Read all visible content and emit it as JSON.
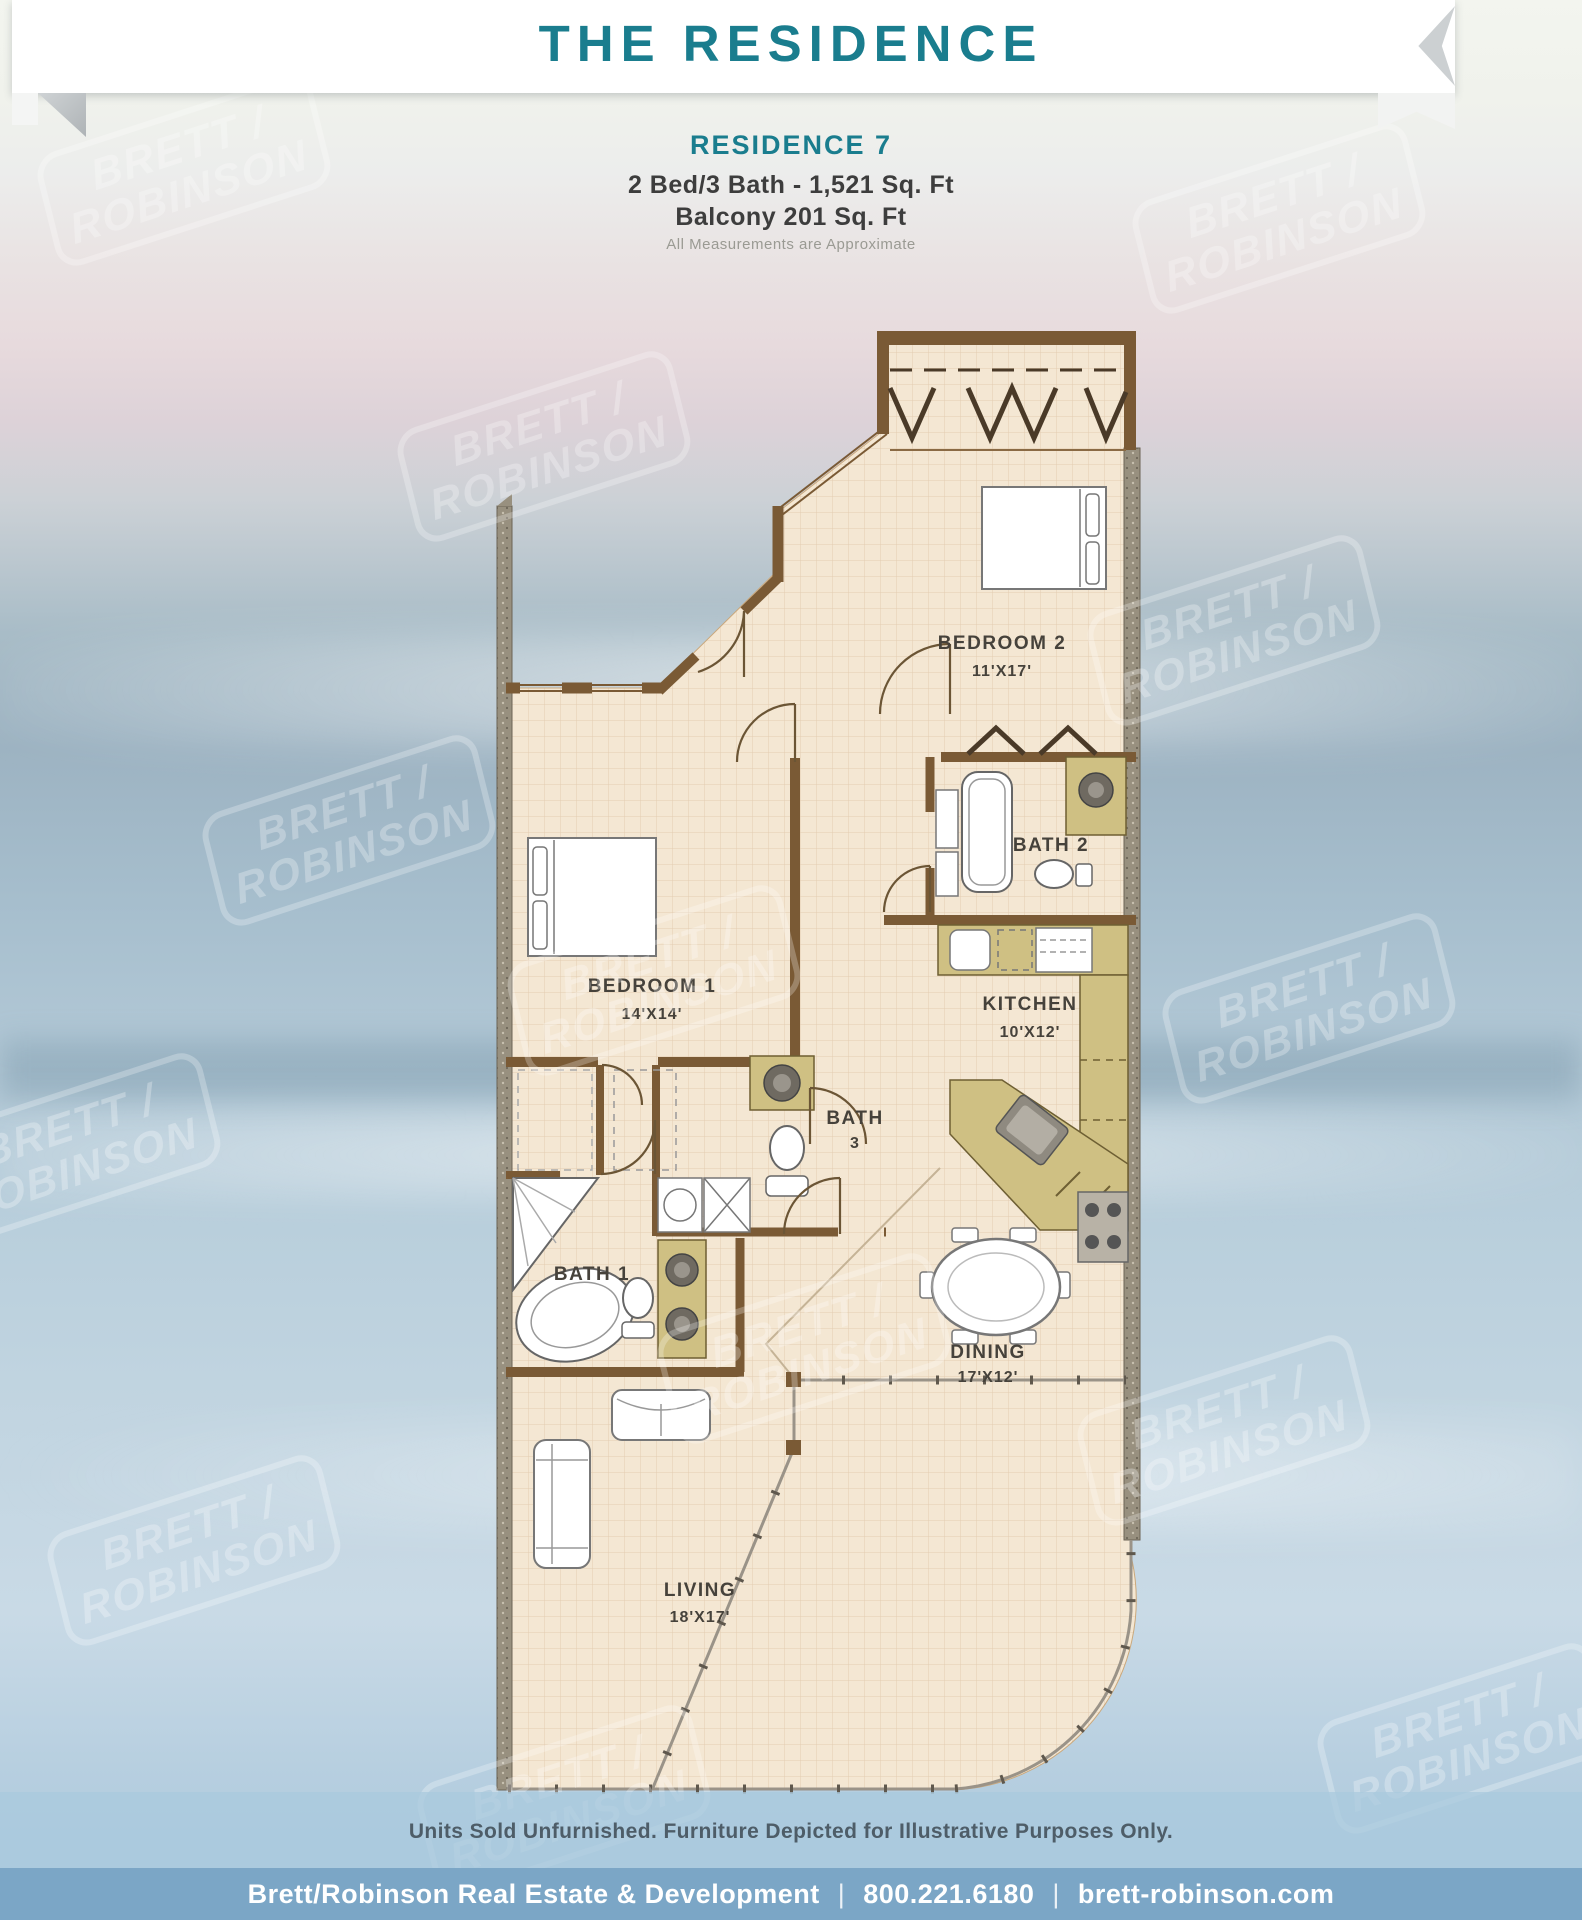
{
  "header": {
    "title": "THE RESIDENCE"
  },
  "unit": {
    "name": "RESIDENCE 7",
    "specs": "2 Bed/3 Bath - 1,521 Sq. Ft",
    "balcony": "Balcony 201 Sq. Ft",
    "disclaimer": "All Measurements are Approximate"
  },
  "floorplan": {
    "rooms": [
      {
        "name": "BEDROOM 2",
        "dims": "11'X17'"
      },
      {
        "name": "BATH 2",
        "dims": ""
      },
      {
        "name": "KITCHEN",
        "dims": "10'X12'"
      },
      {
        "name": "BEDROOM 1",
        "dims": "14'X14'"
      },
      {
        "name": "BATH",
        "dims": "3"
      },
      {
        "name": "BATH 1",
        "dims": ""
      },
      {
        "name": "DINING",
        "dims": "17'X12'"
      },
      {
        "name": "LIVING",
        "dims": "18'X17'"
      }
    ]
  },
  "watermark": {
    "line1": "BRETT /",
    "line2": "ROBINSON"
  },
  "notes": {
    "furnishing": "Units Sold Unfurnished. Furniture Depicted for Illustrative Purposes Only."
  },
  "footer": {
    "company": "Brett/Robinson Real Estate & Development",
    "phone": "800.221.6180",
    "website": "brett-robinson.com",
    "separator": "|"
  },
  "colors": {
    "accent_teal": "#1a7d8e",
    "floor_tan": "#f4e7d3",
    "wall_brown": "#7a5a35",
    "cabinet_khaki": "#cfc083",
    "footer_blue": "#7ba6c6"
  }
}
